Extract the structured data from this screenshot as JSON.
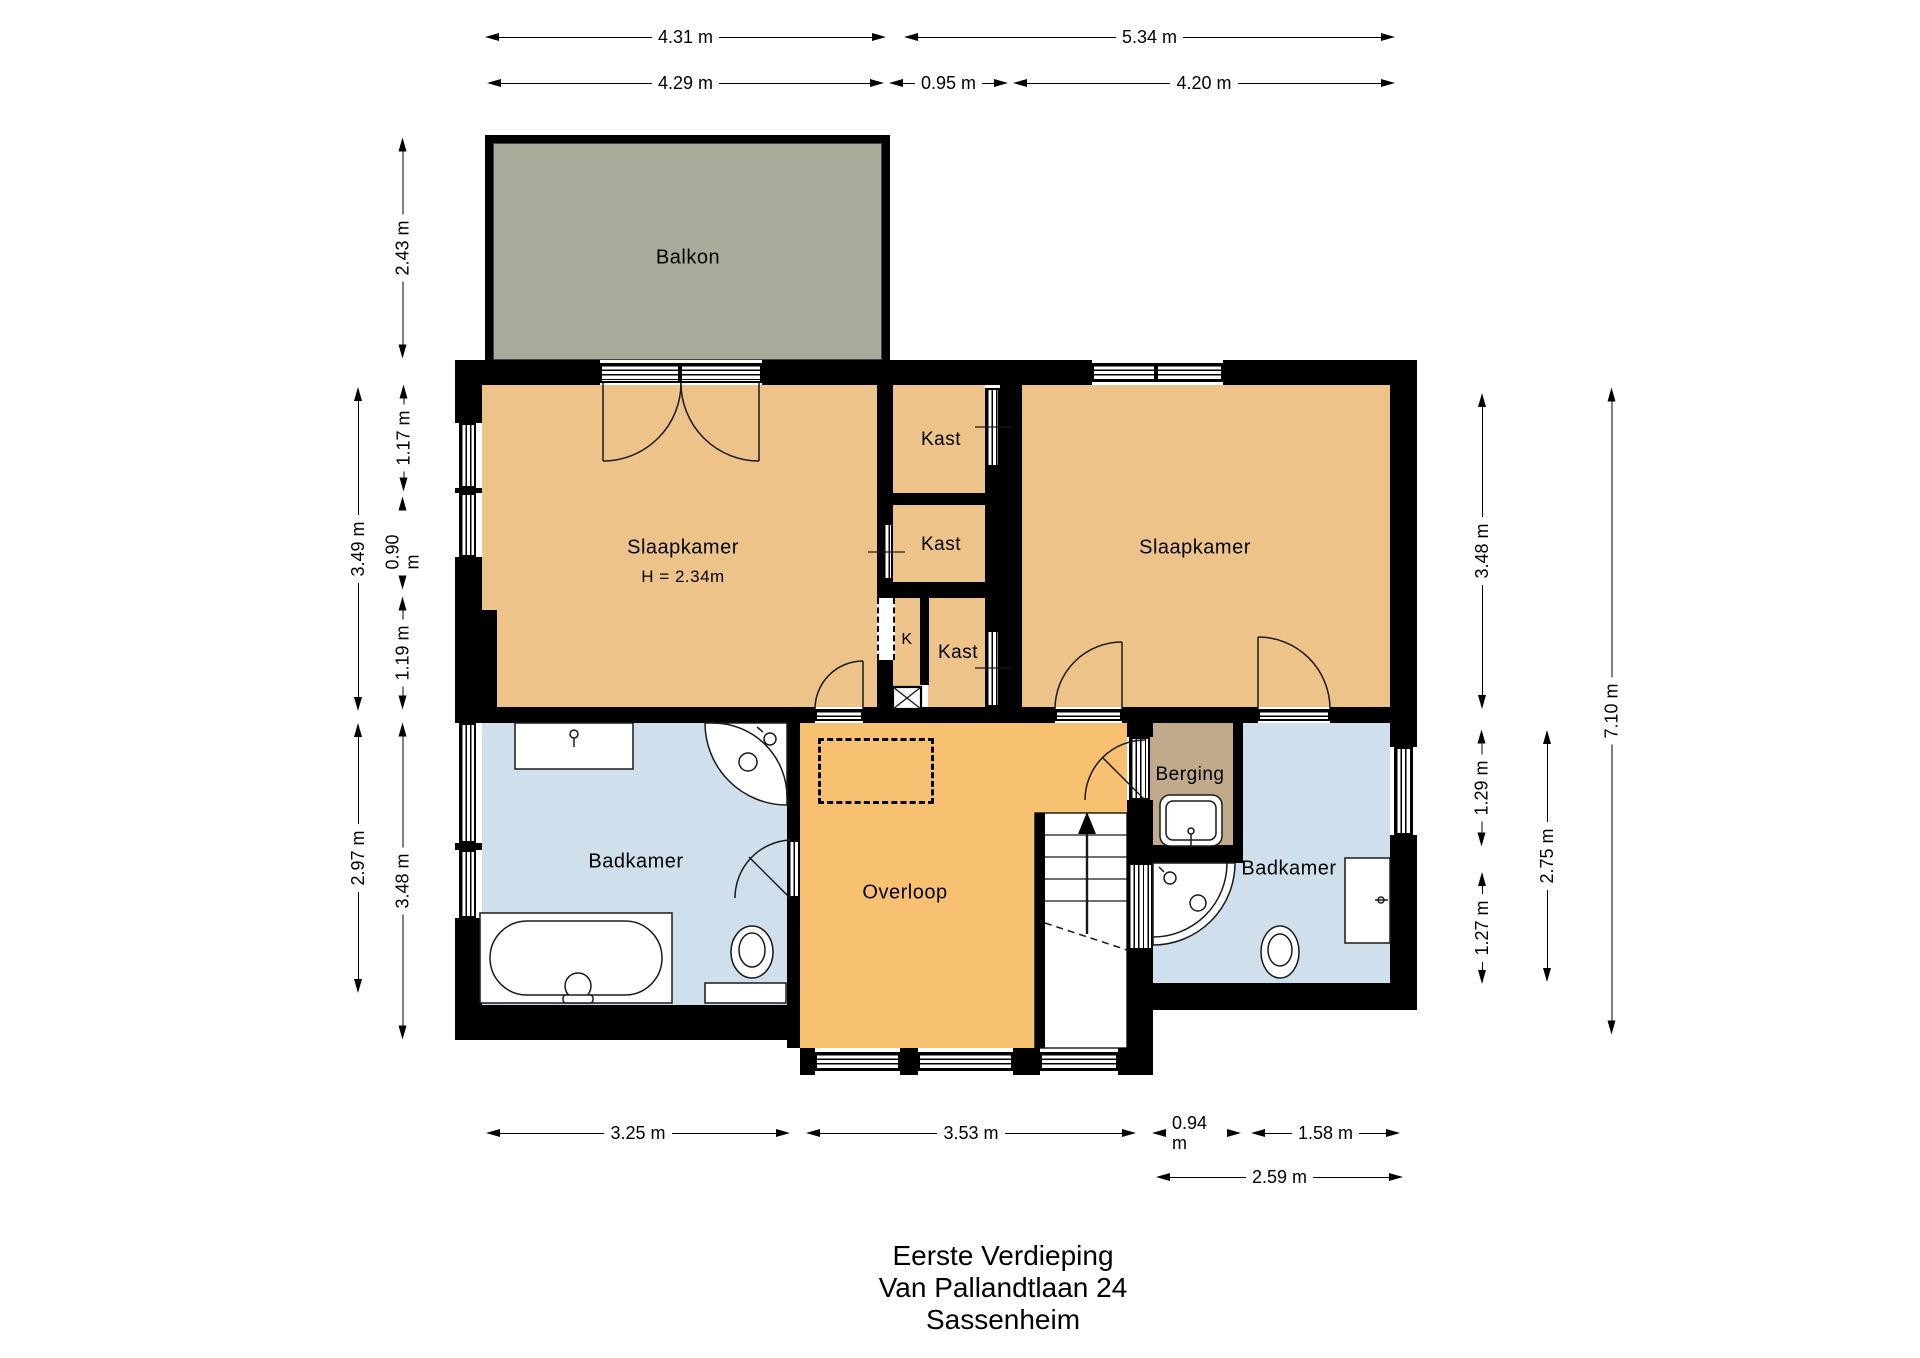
{
  "title": {
    "lines": [
      "Eerste Verdieping",
      "Van Pallandtlaan 24",
      "Sassenheim"
    ]
  },
  "rooms": {
    "balkon": "Balkon",
    "slaapkamer_left": "Slaapkamer",
    "slaapkamer_left_height": "H = 2.34m",
    "slaapkamer_right": "Slaapkamer",
    "kast_1": "Kast",
    "kast_2": "Kast",
    "kast_3": "Kast",
    "k_small": "K",
    "badkamer_left": "Badkamer",
    "overloop": "Overloop",
    "berging": "Berging",
    "badkamer_right": "Badkamer"
  },
  "dims": {
    "top_row1": [
      "4.31 m",
      "5.34 m"
    ],
    "top_row2": [
      "4.29 m",
      "0.95 m",
      "4.20 m"
    ],
    "bottom_row1": [
      "3.25 m",
      "3.53 m",
      "0.94 m",
      "1.58 m"
    ],
    "bottom_row2": [
      "2.59 m"
    ],
    "left_outer": [
      "3.49 m",
      "2.97 m"
    ],
    "left_inner": [
      "2.43 m",
      "1.17 m",
      "0.90 m",
      "1.19 m",
      "3.48 m"
    ],
    "right_inner": [
      "3.48 m",
      "1.29 m",
      "1.27 m"
    ],
    "right_mid": [
      "2.75 m"
    ],
    "right_outer": [
      "7.10 m"
    ]
  },
  "colors": {
    "paper": "#ffffff",
    "wall": "#000000",
    "text": "#000000",
    "room_orange": "#edc389",
    "overloop_orange": "#f8c171",
    "bathroom_blue": "#cfdfec",
    "berging_tan": "#c1aa8b",
    "balkon_gray": "#a8ab9a"
  }
}
